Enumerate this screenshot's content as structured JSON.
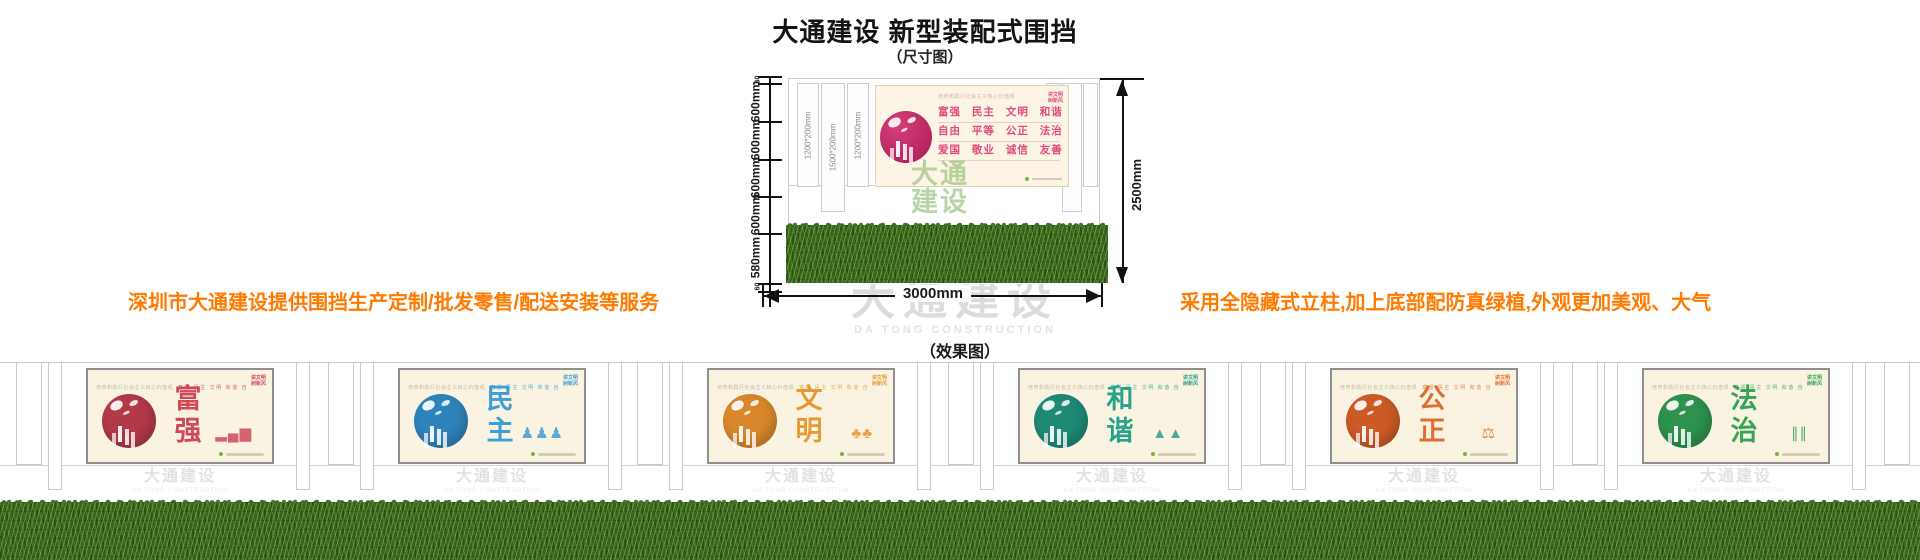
{
  "header": {
    "title": "大通建设 新型装配式围挡",
    "dimension_caption": "（尺寸图）",
    "effect_caption": "（效果图）"
  },
  "notes": {
    "left": "深圳市大通建设提供围挡生产定制/批发零售/配送安装等服务",
    "right": "采用全隐藏式立柱,加上底部配防真绿植,外观更加美观、大气",
    "color": "#ff7a00"
  },
  "watermark": {
    "cn": "大通建设",
    "en": "DA TONG CONSTRUCTION"
  },
  "dimension_diagram": {
    "left_dims": {
      "top_offset": "60",
      "segments": [
        "600mm",
        "600mm",
        "600mm",
        "600mm",
        "580mm"
      ],
      "bottom_offset": "60"
    },
    "height_total": "2500mm",
    "width_total": "3000mm",
    "column_labels": [
      "1200*200mm",
      "1500*200mm",
      "1200*200mm"
    ],
    "banner": {
      "slogan_header": "培育和践行社会主义核心价值观",
      "badge_line1": "讲文明",
      "badge_line2": "树新风",
      "rows": [
        "富强 民主 文明 和谐",
        "自由 平等 公正 法治",
        "爱国 敬业 诚信 友善"
      ],
      "text_color": "#e14b7d"
    },
    "logo_watermark_line1": "大通",
    "logo_watermark_line2": "建设"
  },
  "effect": {
    "board_header": "培育和践行社会主义核心价值观",
    "board_values_row": "富强 民主 文明 和谐 自由 平等 公正 法治 爱国 敬业 诚信 友善",
    "badge_line1": "讲文明",
    "badge_line2": "树新风",
    "panels": [
      {
        "word": "富强",
        "color": "#cf4a58",
        "circle_color": "#b23948",
        "motif": "city-bars"
      },
      {
        "word": "民主",
        "color": "#3e9ed6",
        "circle_color": "#2f83bb",
        "motif": "people"
      },
      {
        "word": "文明",
        "color": "#e59a35",
        "circle_color": "#d8882a",
        "motif": "trees"
      },
      {
        "word": "和谐",
        "color": "#2aa18b",
        "circle_color": "#1e8a76",
        "motif": "mountains"
      },
      {
        "word": "公正",
        "color": "#de6f35",
        "circle_color": "#cc5a26",
        "motif": "justice"
      },
      {
        "word": "法治",
        "color": "#39a35a",
        "circle_color": "#2e914e",
        "motif": "script"
      }
    ]
  }
}
